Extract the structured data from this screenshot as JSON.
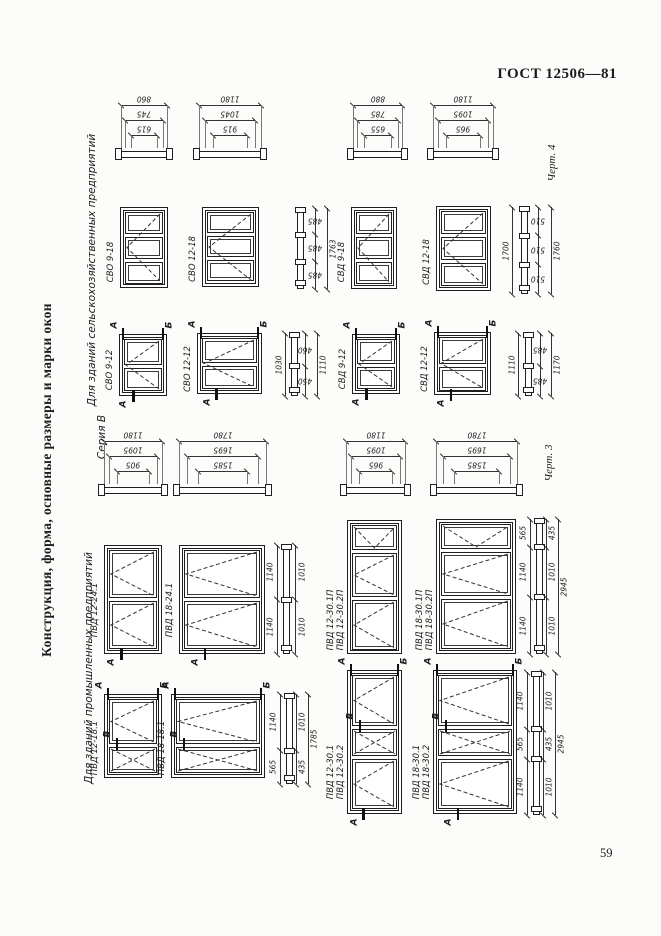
{
  "header": {
    "standard": "ГОСТ 12506—81"
  },
  "footer": {
    "page_number": "59"
  },
  "titles": {
    "main_side": "Конструкция, форма, основные размеры и марки окон",
    "agro_group": "Для зданий сельскохозяйственных предприятий",
    "industrial_group": "Для зданий промышленных предприятий",
    "series": "Серия В",
    "fig4_caption": "Черт. 4",
    "fig3_caption": "Черт. 3"
  },
  "colors": {
    "ink": "#1f1f1f",
    "paper": "#fcfcfa"
  },
  "plan_sections": [
    {
      "id": "ps1",
      "dims": [
        "860",
        "745",
        "615"
      ]
    },
    {
      "id": "ps2",
      "dims": [
        "1180",
        "1045",
        "915"
      ]
    },
    {
      "id": "ps3",
      "dims": [
        "880",
        "785",
        "655"
      ]
    },
    {
      "id": "ps4",
      "dims": [
        "1180",
        "1095",
        "965"
      ]
    },
    {
      "id": "ps5",
      "dims": [
        "1180",
        "1095",
        "905"
      ]
    },
    {
      "id": "ps6",
      "dims": [
        "1780",
        "1695",
        "1585"
      ]
    },
    {
      "id": "ps7",
      "dims": [
        "1180",
        "1095",
        "965"
      ]
    },
    {
      "id": "ps8",
      "dims": [
        "1780",
        "1695",
        "1585"
      ]
    }
  ],
  "windows": [
    {
      "id": "svo918",
      "labels": [
        "СВО 9-18"
      ],
      "markers": []
    },
    {
      "id": "svo1218",
      "labels": [
        "СВО 12-18"
      ],
      "markers": []
    },
    {
      "id": "svd918",
      "labels": [
        "СВД 9-18"
      ],
      "markers": []
    },
    {
      "id": "svd1218",
      "labels": [
        "СВД 12-18"
      ],
      "markers": []
    },
    {
      "id": "svo912",
      "labels": [
        "СВО 9-12"
      ],
      "markers": [
        {
          "pos": "tl",
          "t": "А"
        },
        {
          "pos": "tr",
          "t": "Б"
        },
        {
          "pos": "bc",
          "t": "А"
        }
      ]
    },
    {
      "id": "svo1212",
      "labels": [
        "СВО 12-12"
      ],
      "markers": [
        {
          "pos": "tl",
          "t": "А"
        },
        {
          "pos": "tr",
          "t": "Б"
        },
        {
          "pos": "bc",
          "t": "А"
        }
      ]
    },
    {
      "id": "svd912",
      "labels": [
        "СВД 9-12"
      ],
      "markers": [
        {
          "pos": "tl",
          "t": "А"
        },
        {
          "pos": "tr",
          "t": "Б"
        },
        {
          "pos": "bc",
          "t": "А"
        }
      ]
    },
    {
      "id": "svd1212",
      "labels": [
        "СВД 12-12"
      ],
      "markers": [
        {
          "pos": "tl",
          "t": "А"
        },
        {
          "pos": "tr",
          "t": "Б"
        },
        {
          "pos": "bc",
          "t": "А"
        }
      ]
    },
    {
      "id": "pvd1224",
      "labels": [
        "ПВД 12-24.1"
      ],
      "markers": [
        {
          "pos": "bc",
          "t": "А"
        }
      ]
    },
    {
      "id": "pvd1824",
      "labels": [
        "ПВД 18-24.1"
      ],
      "markers": [
        {
          "pos": "bc",
          "t": "А"
        }
      ]
    },
    {
      "id": "pvd1230p",
      "labels": [
        "ПВД 12-30.1П",
        "ПВД 12-30.2П"
      ],
      "markers": []
    },
    {
      "id": "pvd1830p",
      "labels": [
        "ПВД 18-30.1П",
        "ПВД 18-30.2П"
      ],
      "markers": []
    },
    {
      "id": "pvd1218",
      "labels": [
        "ПВД 12-18.1"
      ],
      "markers": [
        {
          "pos": "tl",
          "t": "А"
        },
        {
          "pos": "tr",
          "t": "Б"
        },
        {
          "pos": "ml",
          "t": "В"
        }
      ]
    },
    {
      "id": "pvd1818",
      "labels": [
        "ПВД 18-18.1"
      ],
      "markers": [
        {
          "pos": "tl",
          "t": "А"
        },
        {
          "pos": "tr",
          "t": "Б"
        },
        {
          "pos": "ml",
          "t": "В"
        }
      ]
    },
    {
      "id": "pvd1230",
      "labels": [
        "ПВД 12-30.1",
        "ПВД 12-30.2"
      ],
      "markers": [
        {
          "pos": "tl",
          "t": "А"
        },
        {
          "pos": "tr",
          "t": "Б"
        },
        {
          "pos": "ml",
          "t": "В"
        },
        {
          "pos": "bc",
          "t": "А"
        }
      ]
    },
    {
      "id": "pvd1830",
      "labels": [
        "ПВД 18-30.1",
        "ПВД 18-30.2"
      ],
      "markers": [
        {
          "pos": "tl",
          "t": "А"
        },
        {
          "pos": "tr",
          "t": "Б"
        },
        {
          "pos": "ml",
          "t": "В"
        },
        {
          "pos": "bc",
          "t": "А"
        }
      ]
    }
  ],
  "v_sections": [
    {
      "id": "vsA",
      "panes": [
        "485",
        "485",
        "485"
      ],
      "totals": [
        "1763"
      ]
    },
    {
      "id": "vsB",
      "panes": [
        "510",
        "510",
        "510"
      ],
      "totals": [
        "1700",
        "1760"
      ]
    },
    {
      "id": "vsC",
      "panes": [
        "460",
        "450"
      ],
      "totals": [
        "1030",
        "1110"
      ]
    },
    {
      "id": "vsD",
      "panes": [
        "485",
        "485"
      ],
      "totals": [
        "1110",
        "1170"
      ]
    },
    {
      "id": "vsE",
      "left": [
        "1140",
        "1140"
      ],
      "right": [
        "1010",
        "1010"
      ],
      "totals": []
    },
    {
      "id": "vsF",
      "left": [
        "565",
        "1140",
        "1140"
      ],
      "right": [
        "435",
        "1010",
        "1010"
      ],
      "totals": [
        "2945"
      ]
    },
    {
      "id": "vsG",
      "left": [
        "1140",
        "565"
      ],
      "right": [
        "1010",
        "435"
      ],
      "totals": [
        "1785"
      ]
    },
    {
      "id": "vsH",
      "left": [
        "1140",
        "565",
        "1140"
      ],
      "right": [
        "1010",
        "435",
        "1010"
      ],
      "totals": [
        "2945"
      ]
    }
  ]
}
